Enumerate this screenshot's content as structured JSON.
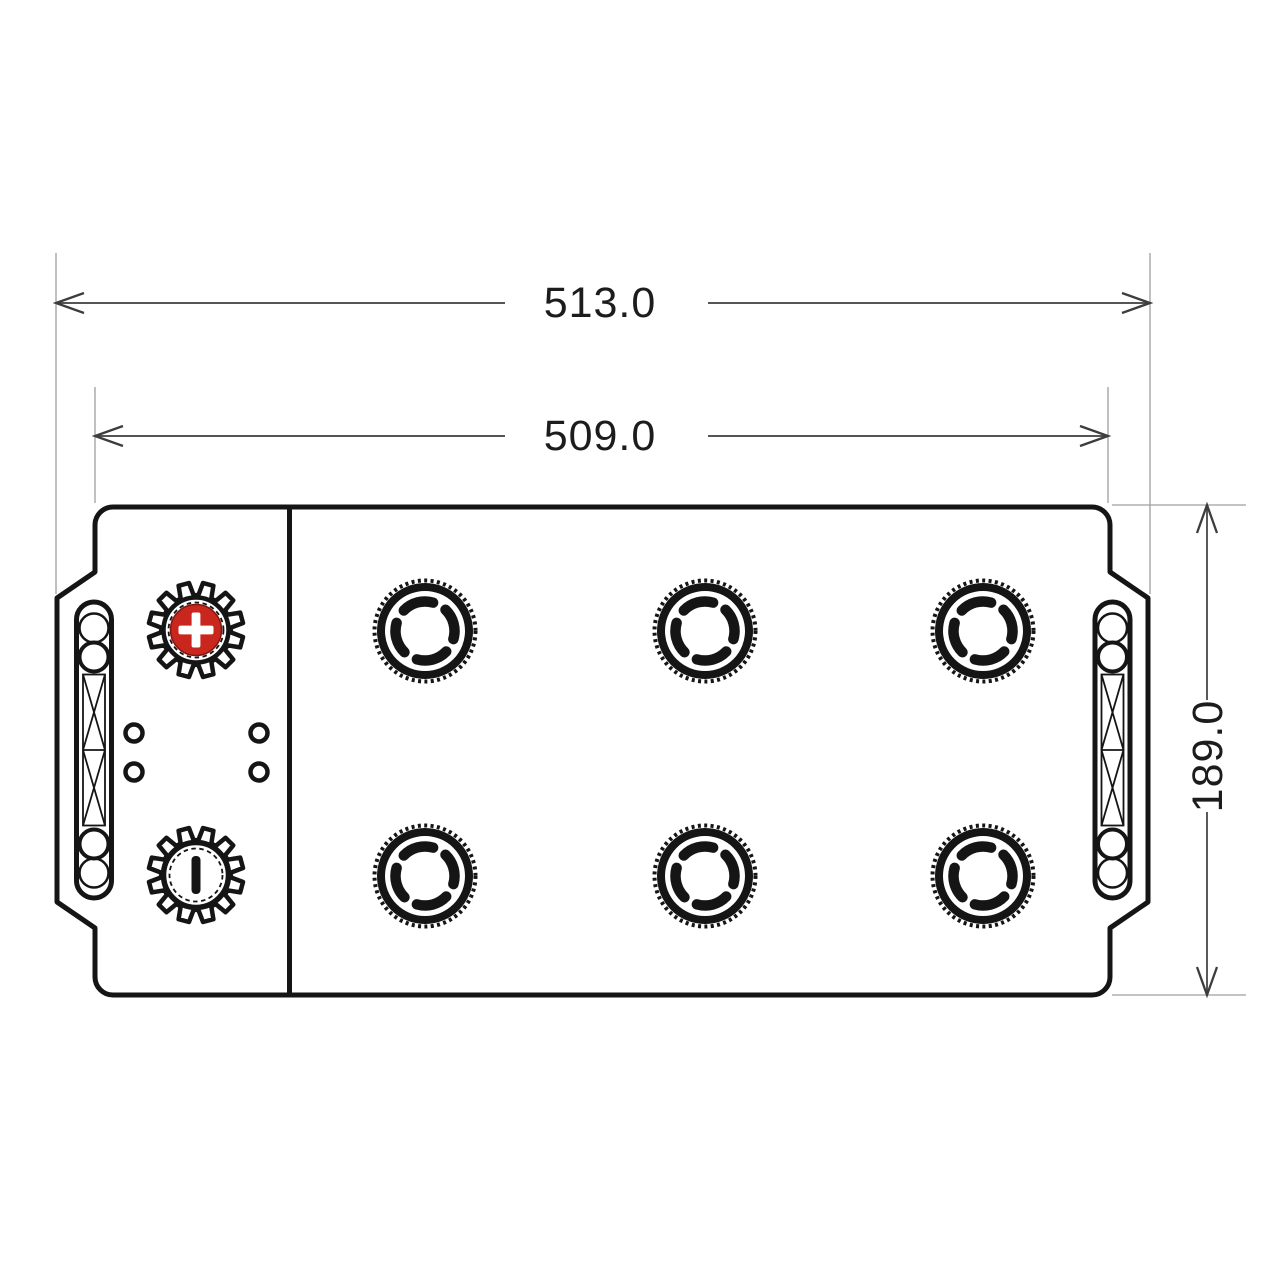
{
  "drawing": {
    "type": "battery-top-view-technical-drawing",
    "dimensions": {
      "overall_length": {
        "label": "513.0"
      },
      "body_length": {
        "label": "509.0"
      },
      "width": {
        "label": "189.0"
      }
    },
    "terminals": {
      "positive": {
        "polarity": "plus",
        "color": "#c9271e"
      },
      "negative": {
        "polarity": "minus",
        "color": "#151515"
      }
    },
    "vent_cap_count": 6,
    "colors": {
      "outline": "#151515",
      "dimension_line": "#3d3d3d",
      "extension_line": "#9f9f9f",
      "background": "#ffffff"
    }
  }
}
